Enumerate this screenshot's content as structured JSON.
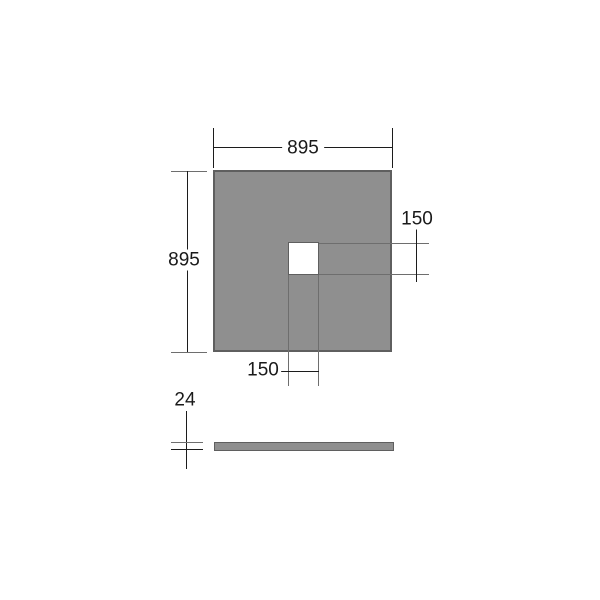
{
  "diagram": {
    "type": "technical-dimension-drawing",
    "plan_view": {
      "width_label": "895",
      "height_label": "895",
      "hole_width_label": "150",
      "hole_height_label": "150"
    },
    "side_view": {
      "thickness_label": "24"
    }
  },
  "colors": {
    "tray-fill": "#8f8f8f",
    "tray-border": "#5f5f5f",
    "dim-line": "#1c1c1c",
    "ext-line": "#6e6e6e",
    "bg": "#ffffff",
    "text": "#1a1a1a"
  }
}
